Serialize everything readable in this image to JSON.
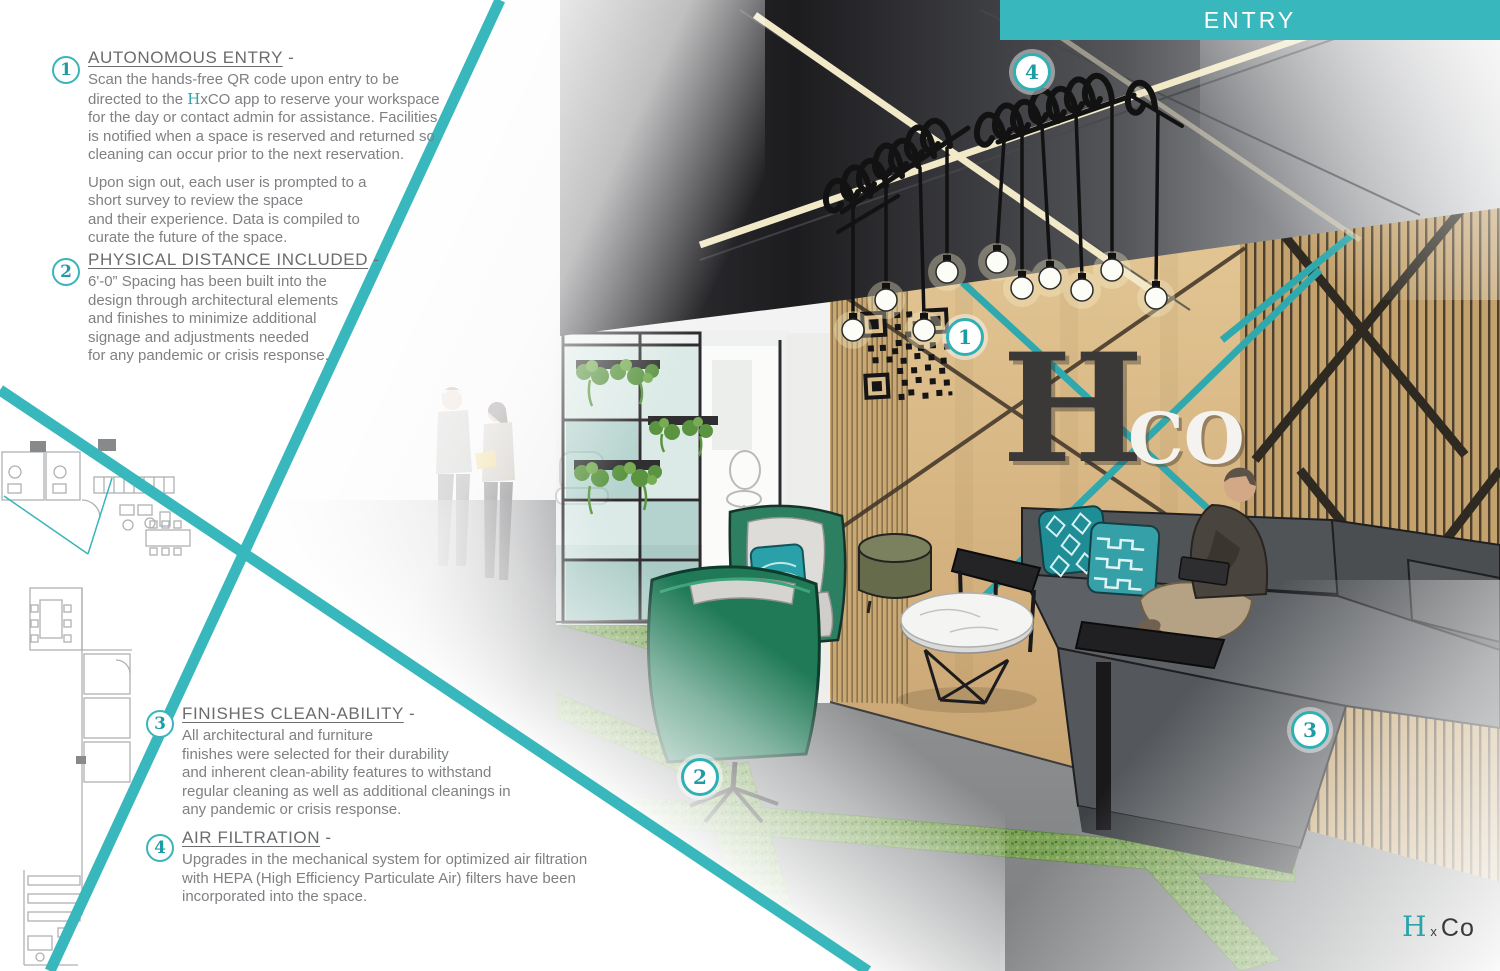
{
  "banner": {
    "title": "ENTRY",
    "color": "#38b7bc"
  },
  "annotations": {
    "item1": {
      "number": "1",
      "title": "AUTONOMOUS ENTRY",
      "dash": " -",
      "p1a": "Scan the hands-free QR code upon entry to be\ndirected to the ",
      "brand_h": "H",
      "p1b": "xCO app to reserve your workspace\nfor the day or contact admin for assistance. Facilities\nis notified when a space is reserved and returned so\ncleaning can occur prior to the next reservation.",
      "p2": "Upon sign out, each user is prompted to a\nshort survey to review the space\nand their experience. Data is compiled to\ncurate the future of the space."
    },
    "item2": {
      "number": "2",
      "title": "PHYSICAL DISTANCE INCLUDED",
      "dash": " -",
      "p1": "6'-0” Spacing has been built into the\ndesign through architectural elements\nand finishes to minimize additional\nsignage and adjustments needed\nfor any pandemic or crisis response."
    },
    "item3": {
      "number": "3",
      "title": "FINISHES CLEAN-ABILITY",
      "dash": " -",
      "p1": "All architectural and furniture\nfinishes were selected for their durability\nand inherent clean-ability features to withstand\nregular cleaning as well as additional cleanings in\nany pandemic or crisis response."
    },
    "item4": {
      "number": "4",
      "title": "AIR FILTRATION",
      "dash": " -",
      "p1": "Upgrades in the mechanical system for optimized air filtration\nwith HEPA (High Efficiency Particulate Air) filters have been\nincorporated into the space."
    }
  },
  "scene": {
    "markers": {
      "m1": "1",
      "m2": "2",
      "m3": "3",
      "m4": "4"
    },
    "wall_letters": {
      "h": "H",
      "co": "CO"
    },
    "colors": {
      "accent_teal": "#38b7bc",
      "wood": "#d7b98a",
      "ceiling_dark": "#1c1c1f",
      "floor_gray": "#8b8d90",
      "grass_green": "#7ba257",
      "sofa_gray": "#54575a",
      "chair_green": "#1f8a63",
      "pillow_teal": "#2a9aa3",
      "text_gray": "#7e8083"
    }
  },
  "logo": {
    "h": "H",
    "x": "x",
    "co": "Co"
  }
}
